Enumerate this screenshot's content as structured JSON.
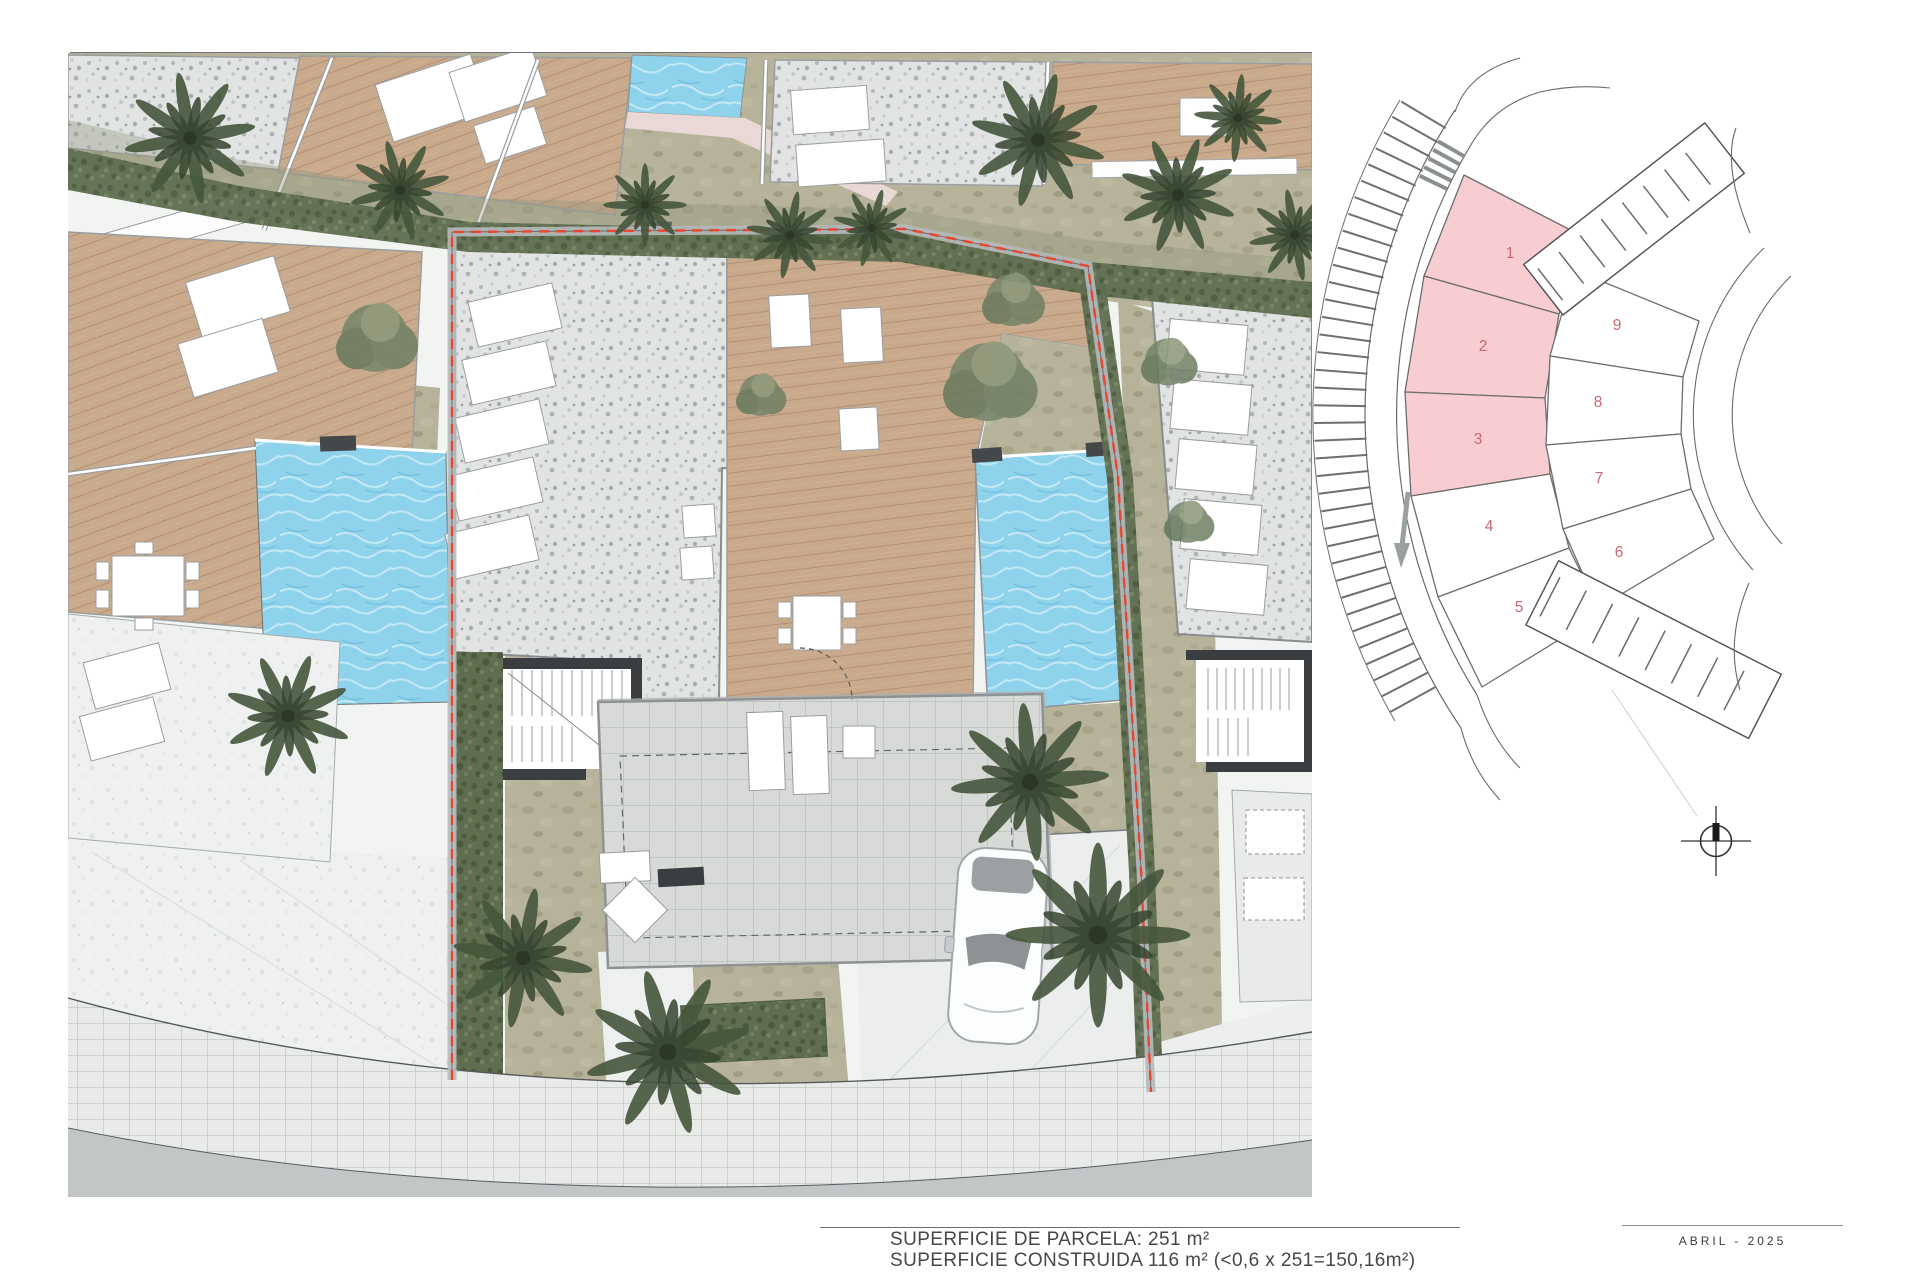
{
  "footer": {
    "plot_area_label": "SUPERFICIE DE PARCELA: 251 m²",
    "built_area_label": "SUPERFICIE CONSTRUIDA 116 m² (<0,6 x 251=150,16m²)",
    "date_label": "ABRIL - 2025"
  },
  "key_plan": {
    "plots": [
      {
        "number": "1",
        "highlighted": true
      },
      {
        "number": "2",
        "highlighted": true
      },
      {
        "number": "3",
        "highlighted": true
      },
      {
        "number": "4",
        "highlighted": false
      },
      {
        "number": "5",
        "highlighted": false
      },
      {
        "number": "6",
        "highlighted": false
      },
      {
        "number": "7",
        "highlighted": false
      },
      {
        "number": "8",
        "highlighted": false
      },
      {
        "number": "9",
        "highlighted": false
      }
    ],
    "highlight_color": "#f8cdd2",
    "number_color": "#c9686e"
  },
  "site_plan": {
    "boundary_color": "#e8472f",
    "pool_color": "#8ed2ec",
    "deck_color": "#c9aa8c",
    "gravel_color": "#e2e4e4",
    "hedge_color": "#5f6d50",
    "road_color": "#c2c6c7"
  }
}
